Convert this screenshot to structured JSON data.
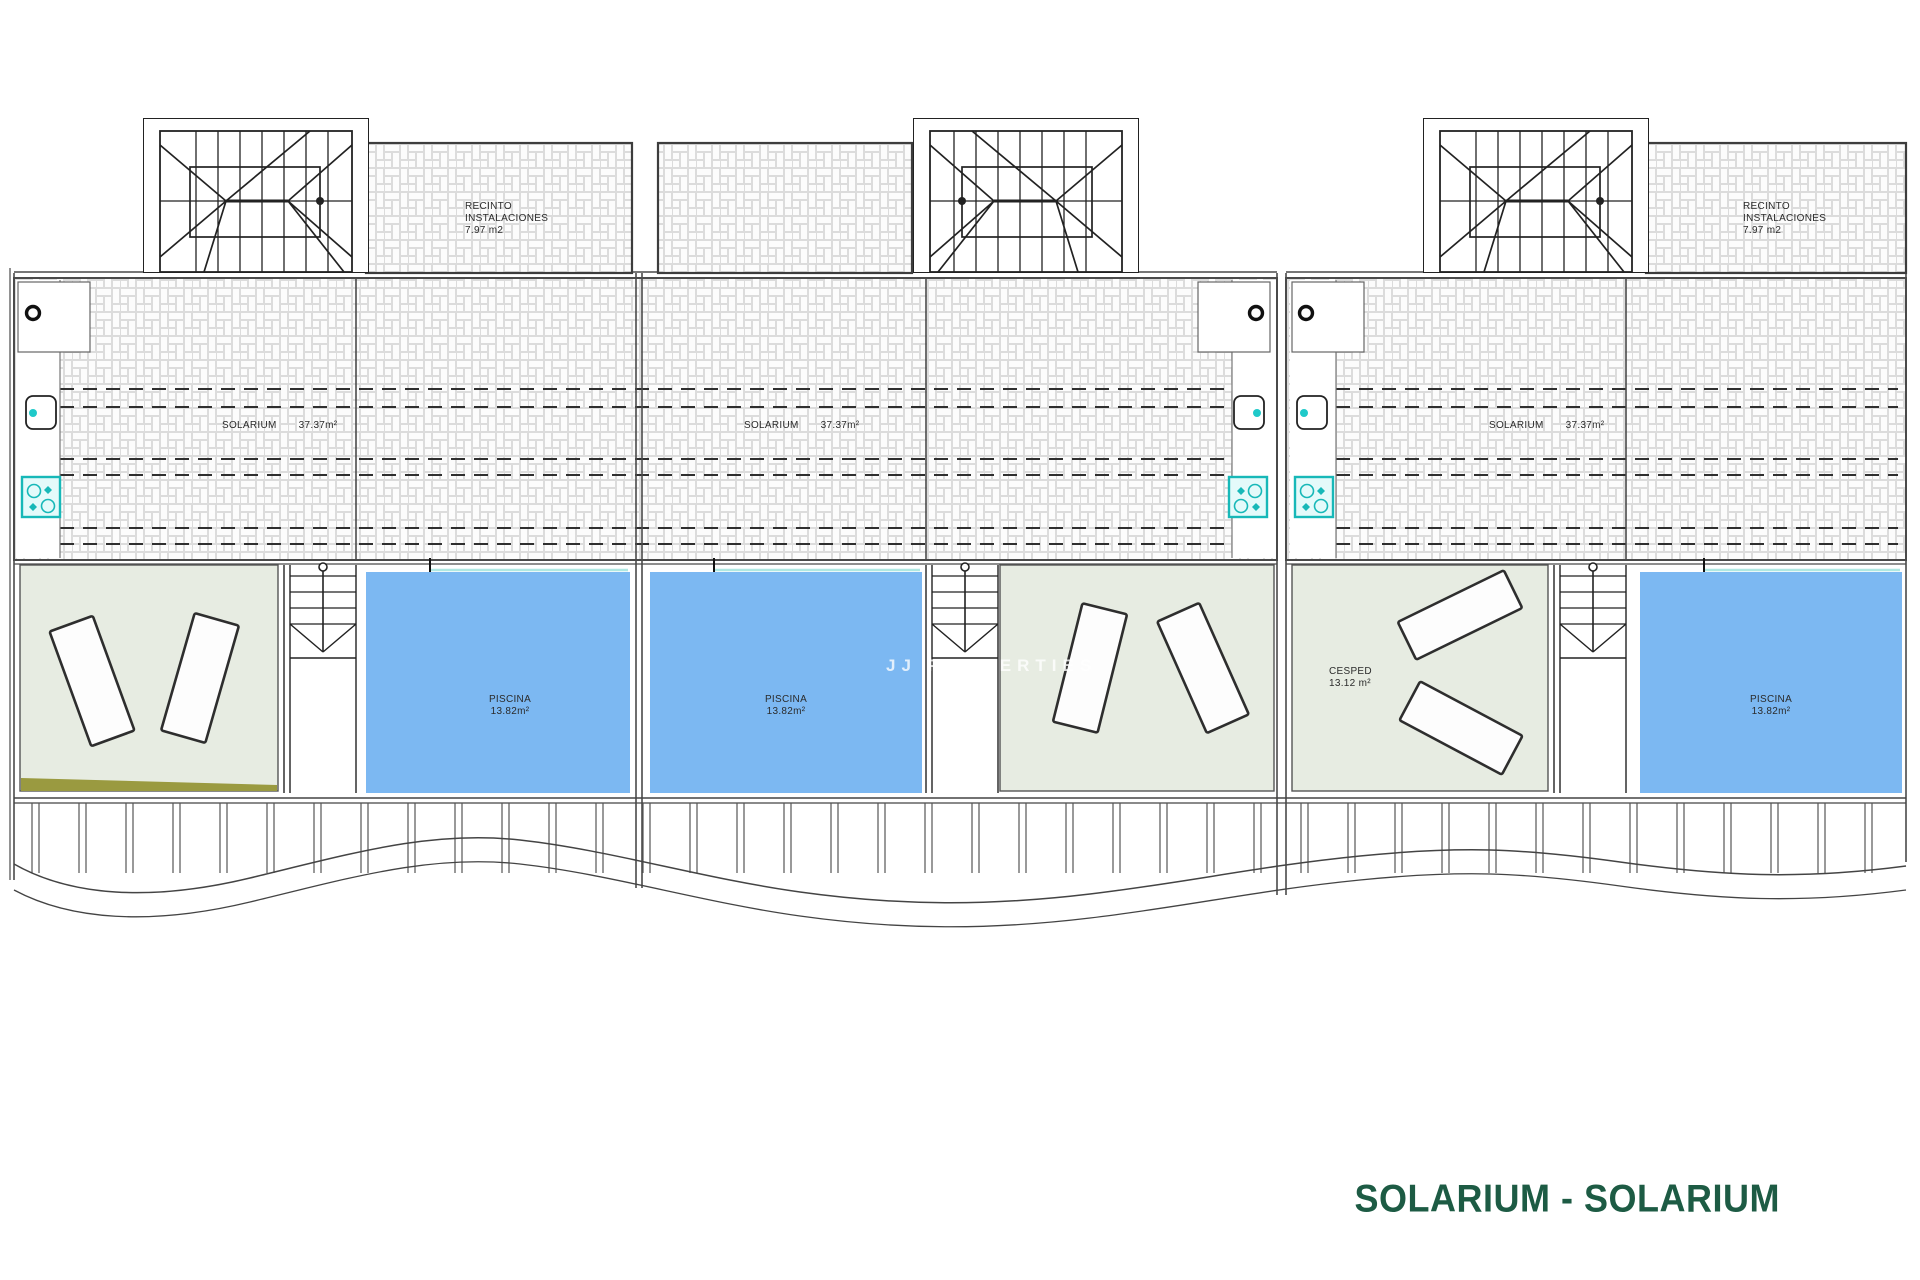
{
  "title": "SOLARIUM - SOLARIUM",
  "watermark": "JJ PROPERTIES",
  "labels": {
    "recinto": [
      {
        "line1": "RECINTO",
        "line2": "INSTALACIONES",
        "line3": "7.97 m2"
      },
      {
        "line1": "RECINTO",
        "line2": "INSTALACIONES",
        "line3": "7.97 m2"
      }
    ],
    "solarium": [
      {
        "name": "SOLARIUM",
        "area": "37.37m²"
      },
      {
        "name": "SOLARIUM",
        "area": "37.37m²"
      },
      {
        "name": "SOLARIUM",
        "area": "37.37m²"
      }
    ],
    "piscina": [
      {
        "name": "PISCINA",
        "area": "13.82m²"
      },
      {
        "name": "PISCINA",
        "area": "13.82m²"
      },
      {
        "name": "PISCINA",
        "area": "13.82m²"
      }
    ],
    "cesped": {
      "name": "CESPED",
      "area": "13.12 m²"
    }
  },
  "colors": {
    "pool": "#7cb8f2",
    "lawn": "#e7ece2",
    "olive": "#9a9a40",
    "fixture_accent": "#1fc9c9",
    "title_green": "#1d5b44",
    "waterline": "#aee8e2"
  }
}
